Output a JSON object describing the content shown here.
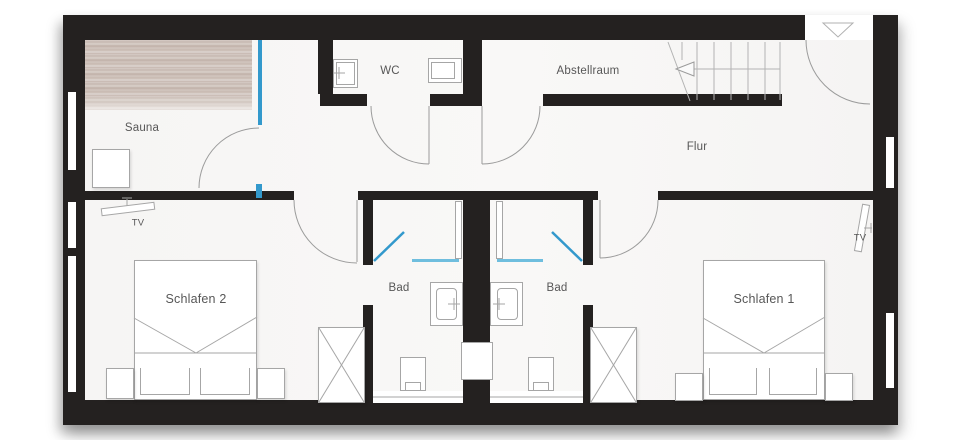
{
  "plan_title": "Obergeschoss Grundriss",
  "rooms": {
    "sauna": {
      "label": "Sauna"
    },
    "wc": {
      "label": "WC"
    },
    "storage": {
      "label": "Abstellraum"
    },
    "hallway": {
      "label": "Flur"
    },
    "bedroom2": {
      "label": "Schlafen 2"
    },
    "bath_left": {
      "label": "Bad"
    },
    "bath_right": {
      "label": "Bad"
    },
    "bedroom1": {
      "label": "Schlafen 1"
    }
  },
  "fixtures": {
    "tv_bedroom2": {
      "label": "TV"
    },
    "tv_bedroom1": {
      "label": "TV"
    }
  },
  "colors": {
    "wall": "#242120",
    "glass_blue": "#3399cc",
    "shower_glass_blue": "#6fbede",
    "floor": "#f8f8f7",
    "line_gray": "#9b9b9b",
    "label_text": "#575757",
    "wood_light": "#dad1cb",
    "wood_dark": "#bfb0a7"
  }
}
